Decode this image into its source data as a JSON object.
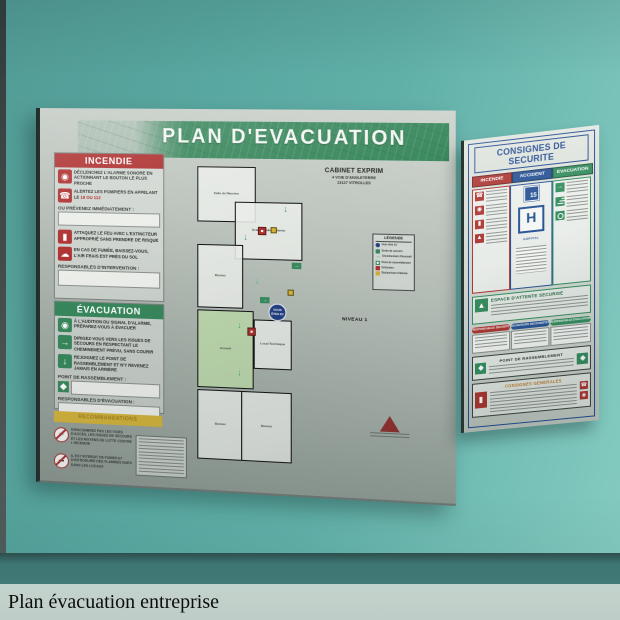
{
  "caption": {
    "title": "Plan évacuation entreprise"
  },
  "colors": {
    "wall_teal": "#5aa8a1",
    "sign_green": "#2e8b58",
    "sign_red": "#bf2b2b",
    "sign_blue": "#1d4b9a",
    "sign_yellow": "#d9b327",
    "panel_silver": "#b4bcb6",
    "caption_bg": "#cfddd7"
  },
  "plan_sign": {
    "title": "PLAN  D'EVACUATION",
    "company_name": "CABINET EXPRIM",
    "address1": "4 VOIE D'ANGLETERRE",
    "address2": "13127 VITROLLES",
    "level": "NIVEAU 1",
    "you_are_here": "VOUS ÊTES ICI",
    "incendie": {
      "header": "INCENDIE",
      "item1": "Déclenchez l'alarme sonore en actionnant le bouton le plus proche",
      "item2_pre": "Alertez les pompiers en appelant le",
      "item2_num": "18 ou 112",
      "notify_label": "Ou prévenez immédiatement :",
      "item3": "Attaquez le feu avec l'extincteur approprié sans prendre de risque",
      "item4": "En cas de fumée, baissez-vous, l'air frais est près du sol",
      "resp_label": "Responsables d'intervention :"
    },
    "evacuation": {
      "header": "ÉVACUATION",
      "item1": "À l'audition du signal d'alarme, préparez-vous à évacuer",
      "item2": "Dirigez-vous vers les issues de secours en respectant le cheminement prévu, sans courir",
      "item3": "Rejoignez le point de rassemblement et n'y revenez jamais en arrière",
      "rassemblement_label": "Point de rassemblement :",
      "resp_label": "Responsables d'évacuation :"
    },
    "recommandations_header": "RECOMMANDATIONS",
    "warning1": "N'encombrez pas les voies d'accès, les issues de secours et les moyens de lutte contre l'incendie",
    "warning2": "Il est interdit de fumer et d'introduire des flammes nues dans les locaux",
    "legend": {
      "title": "LÉGENDE",
      "items": [
        "Vous êtes ici",
        "Sortie de secours",
        "Cheminement d'évacuation",
        "Point de rassemblement",
        "Extincteur",
        "Déclencheur d'alarme"
      ]
    },
    "rooms": {
      "reunion": "Salle de Réunion",
      "attente": "Grande Salle d'attente",
      "bureau1": "Bureau",
      "accueil": "Accueil",
      "technique": "Local Technique",
      "bureau2": "Bureau",
      "bureau3": "Bureau"
    }
  },
  "consignes_sign": {
    "title": "CONSIGNES DE SECURITE",
    "col1_header": "INCENDIE",
    "col2_header": "ACCIDENT",
    "col3_header": "EVACUATION",
    "samu_number": "15",
    "hopital_letter": "H",
    "hopital_label": "HOPITAL",
    "espace_title": "ESPACE D'ATTENTE SECURISE",
    "pill1": "RESPONSABLES SECURITE",
    "pill2": "SAUVETEURS SECOURISTES",
    "pill3": "RESPONSABLES EVACUATION",
    "rassemblement_title": "POINT DE RASSEMBLEMENT",
    "generales_title": "CONSIGNES GENERALES"
  }
}
